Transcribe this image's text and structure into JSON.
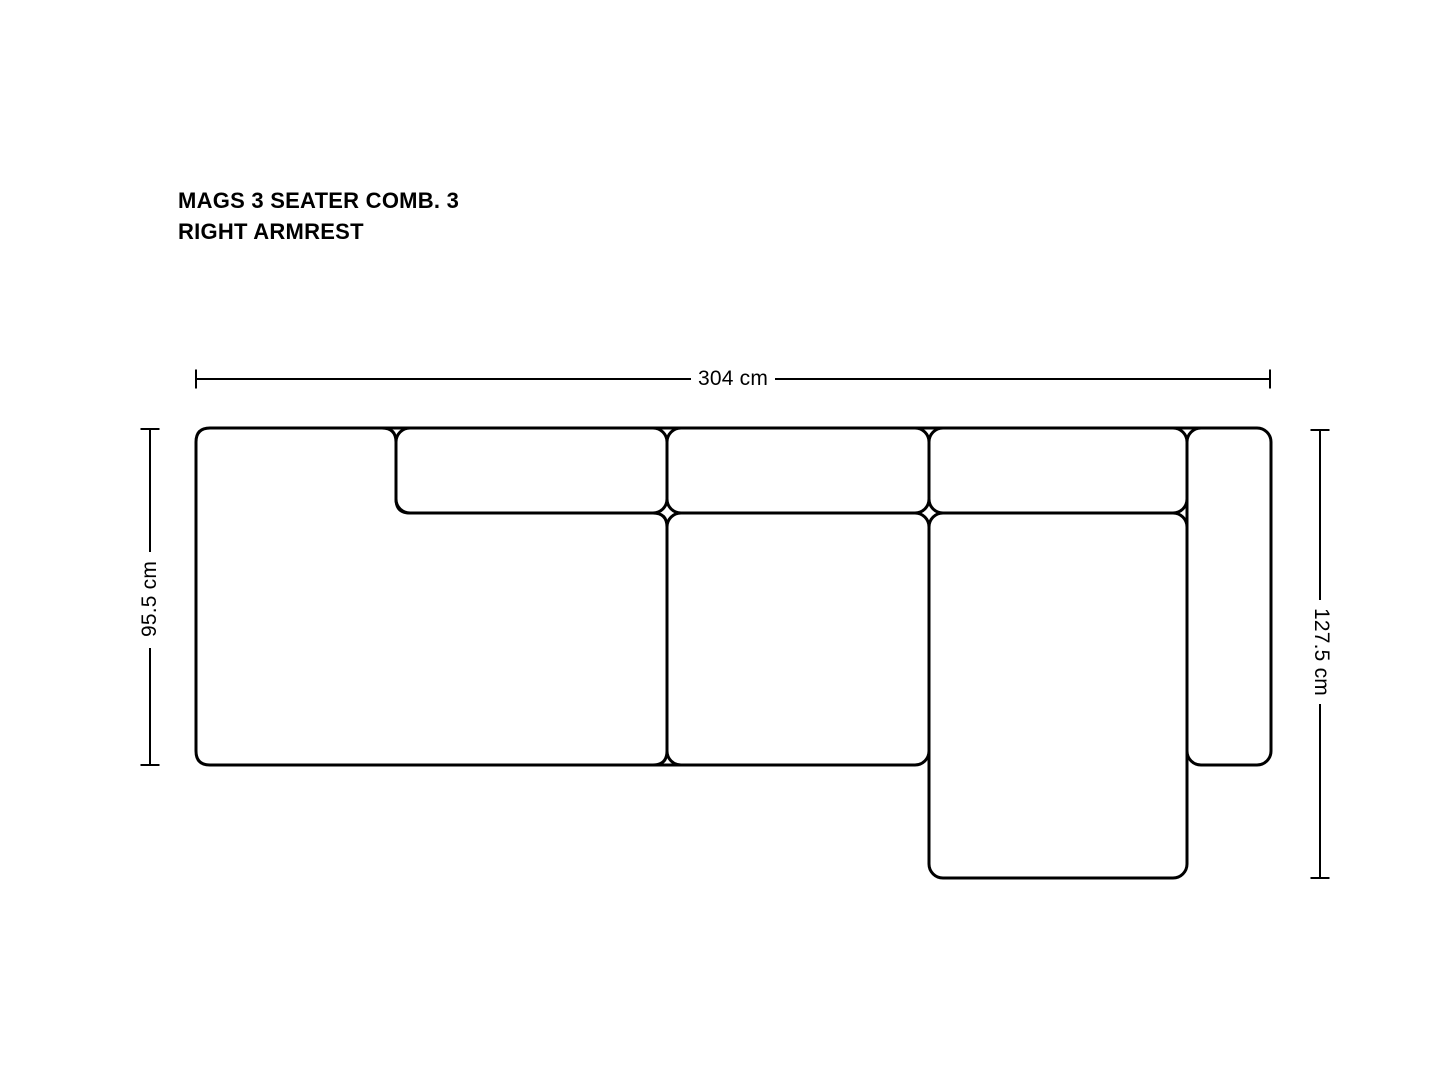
{
  "page": {
    "background_color": "#ffffff",
    "line_color": "#000000"
  },
  "title": {
    "line1": "MAGS 3 SEATER COMB. 3",
    "line2": "RIGHT ARMREST"
  },
  "dimensions": {
    "overall_width": "304 cm",
    "left_depth": "95.5 cm",
    "right_depth": "127.5 cm"
  },
  "drawing": {
    "modules": [
      "left-seat-module",
      "left-backrest-cushion",
      "middle-backrest-cushion",
      "middle-seat-cushion",
      "chaise-backrest-cushion",
      "chaise-longue-seat",
      "right-armrest"
    ]
  }
}
